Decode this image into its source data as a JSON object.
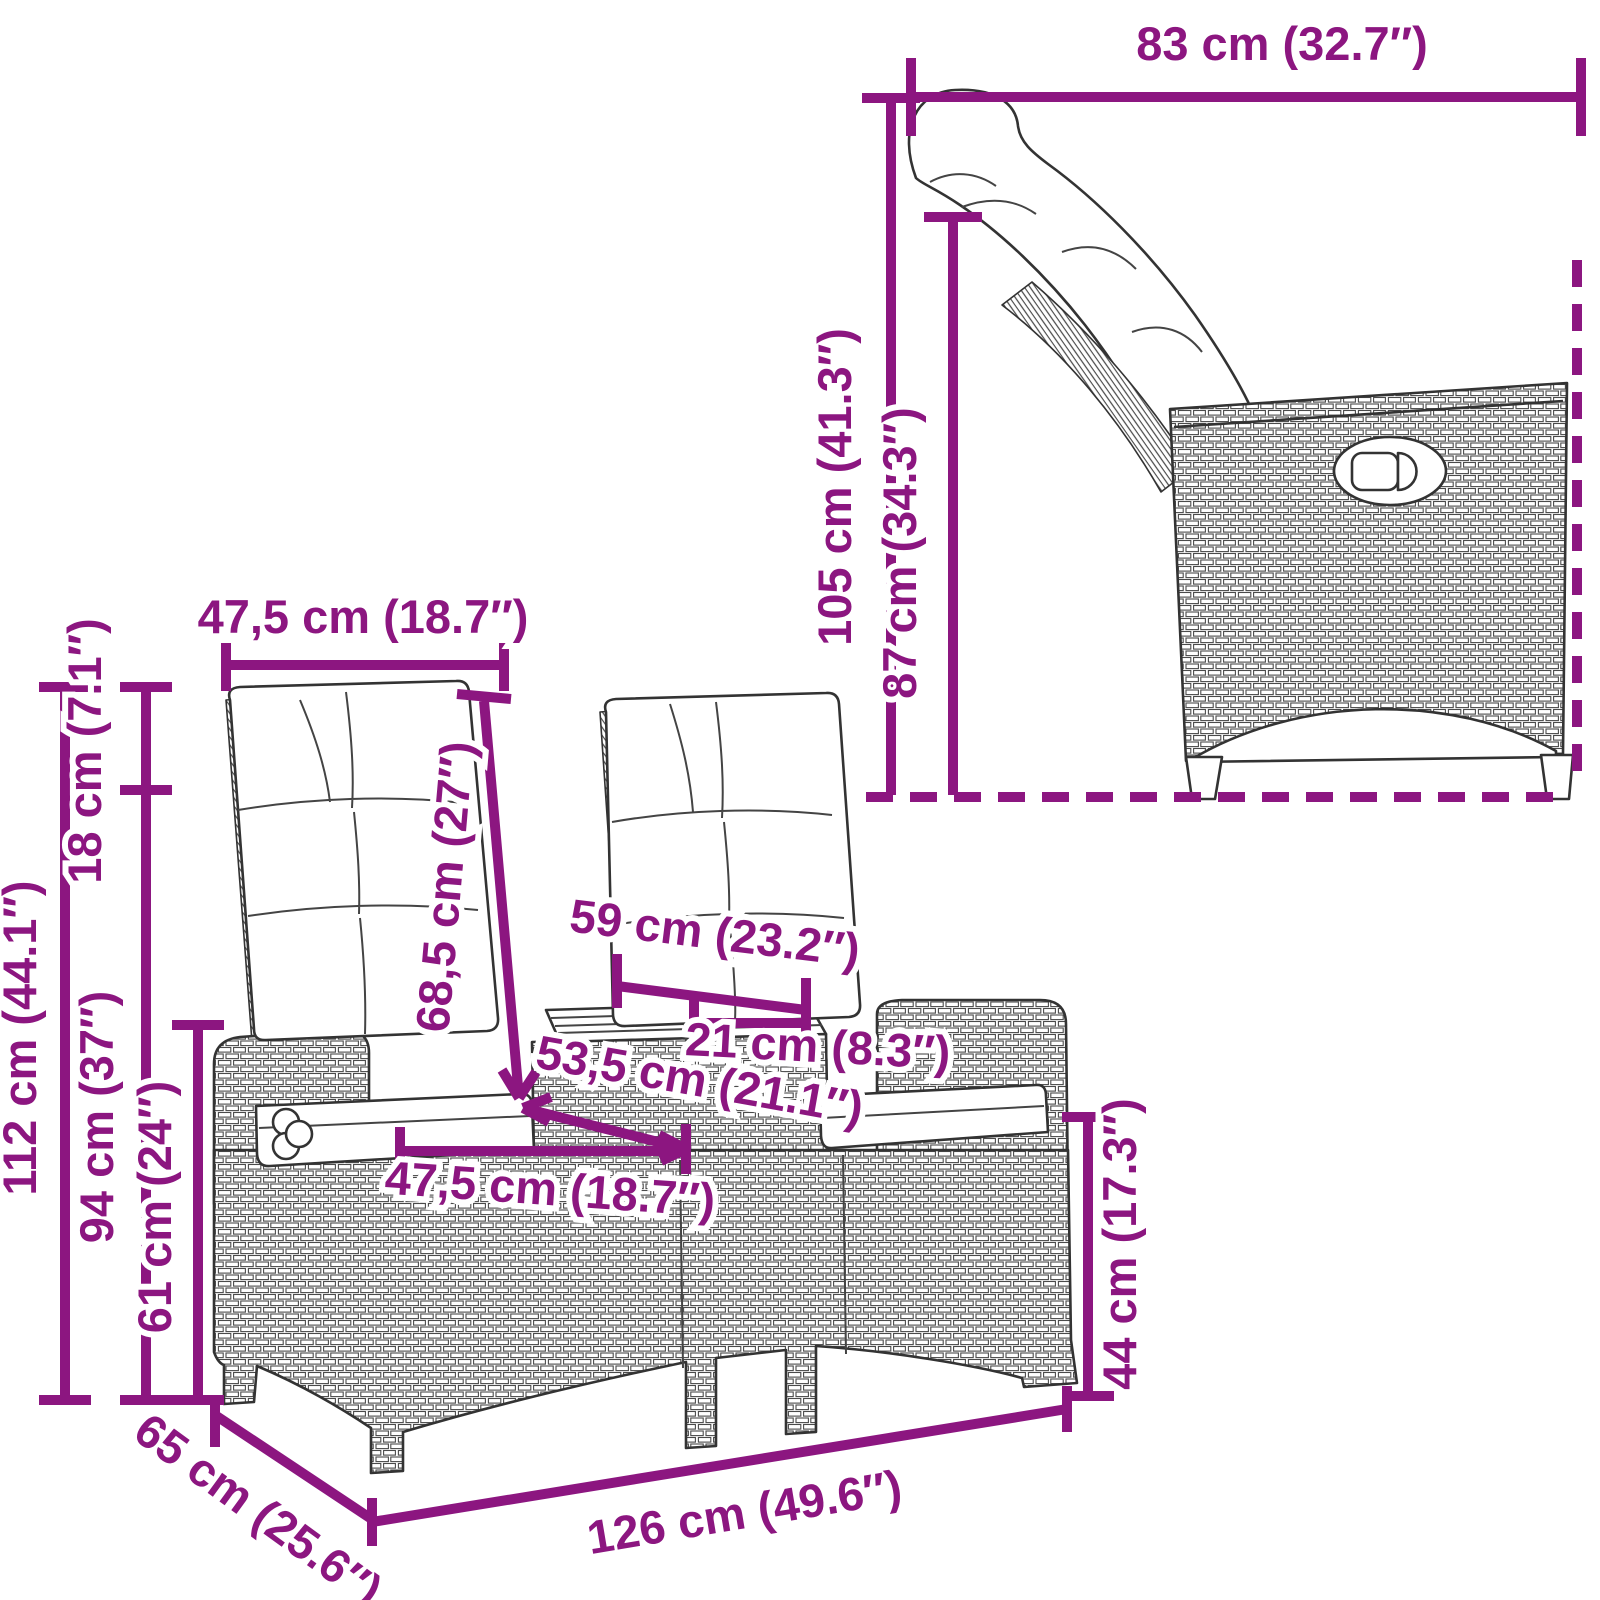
{
  "diagram": {
    "kind": "furniture-dimension-diagram",
    "subject": "2-seater reclining garden sofa with center table, poly rattan",
    "views": [
      "side-view-reclined",
      "front-view"
    ],
    "units": [
      "cm",
      "inch"
    ]
  },
  "colors": {
    "dimension_accent": "#8c1680",
    "line_art": "#333333",
    "background": "#ffffff"
  },
  "dimensions": {
    "side_view": [
      {
        "id": "total_depth_reclined",
        "label": "83 cm (32.7″)",
        "cm": 83,
        "inch": 32.7,
        "orientation": "horizontal"
      },
      {
        "id": "total_height_reclined",
        "label": "105 cm (41.3″)",
        "cm": 105,
        "inch": 41.3,
        "orientation": "vertical"
      },
      {
        "id": "backrest_pivot_height",
        "label": "87 cm (34.3″)",
        "cm": 87,
        "inch": 34.3,
        "orientation": "vertical"
      }
    ],
    "front_view": [
      {
        "id": "backrest_cushion_width",
        "label": "47,5 cm (18.7″)",
        "cm": 47.5,
        "inch": 18.7,
        "orientation": "horizontal"
      },
      {
        "id": "headrest_segment_height",
        "label": "18 cm (7.1″)",
        "cm": 18,
        "inch": 7.1,
        "orientation": "vertical"
      },
      {
        "id": "total_height",
        "label": "112 cm (44.1″)",
        "cm": 112,
        "inch": 44.1,
        "orientation": "vertical"
      },
      {
        "id": "backrest_height",
        "label": "94 cm (37″)",
        "cm": 94,
        "inch": 37,
        "orientation": "vertical"
      },
      {
        "id": "armrest_height",
        "label": "61 cm (24″)",
        "cm": 61,
        "inch": 24,
        "orientation": "vertical"
      },
      {
        "id": "backrest_length",
        "label": "68,5 cm (27″)",
        "cm": 68.5,
        "inch": 27,
        "orientation": "diagonal"
      },
      {
        "id": "table_depth",
        "label": "59 cm (23.2″)",
        "cm": 59,
        "inch": 23.2,
        "orientation": "horizontal"
      },
      {
        "id": "table_width",
        "label": "21 cm (8.3″)",
        "cm": 21,
        "inch": 8.3,
        "orientation": "horizontal"
      },
      {
        "id": "seat_depth",
        "label": "53,5 cm (21.1″)",
        "cm": 53.5,
        "inch": 21.1,
        "orientation": "diagonal"
      },
      {
        "id": "seat_width",
        "label": "47,5 cm (18.7″)",
        "cm": 47.5,
        "inch": 18.7,
        "orientation": "horizontal"
      },
      {
        "id": "seat_height",
        "label": "44 cm (17.3″)",
        "cm": 44,
        "inch": 17.3,
        "orientation": "vertical"
      },
      {
        "id": "total_width",
        "label": "126 cm (49.6″)",
        "cm": 126,
        "inch": 49.6,
        "orientation": "horizontal"
      },
      {
        "id": "total_depth",
        "label": "65 cm (25.6″)",
        "cm": 65,
        "inch": 25.6,
        "orientation": "diagonal"
      }
    ]
  }
}
